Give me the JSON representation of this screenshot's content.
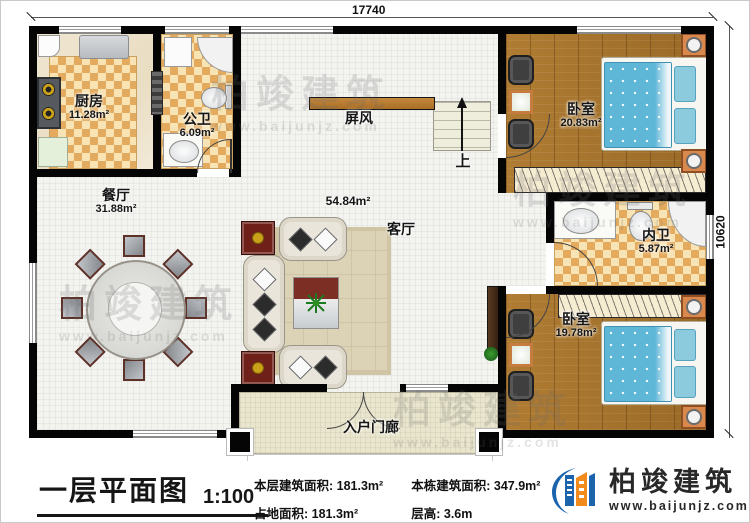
{
  "dimensions": {
    "top": "17740",
    "right": "10620"
  },
  "rooms": {
    "kitchen": {
      "name": "厨房",
      "area": "11.28m²"
    },
    "public_bath": {
      "name": "公卫",
      "area": "6.09m²"
    },
    "dining": {
      "name": "餐厅",
      "area": "31.88m²"
    },
    "living": {
      "name": "客厅",
      "area": "54.84m²"
    },
    "bedroom_top": {
      "name": "卧室",
      "area": "20.83m²"
    },
    "inner_bath": {
      "name": "内卫",
      "area": "5.87m²"
    },
    "bedroom_bottom": {
      "name": "卧室",
      "area": "19.78m²"
    },
    "porch": {
      "name": "入户门廊"
    }
  },
  "annotations": {
    "screen": "屏风",
    "stairs_up": "上"
  },
  "footer": {
    "title": "一层平面图",
    "scale": "1:100",
    "stats": [
      {
        "label": "本层建筑面积:",
        "value": "181.3m²"
      },
      {
        "label": "本栋建筑面积:",
        "value": "347.9m²"
      },
      {
        "label": "占地面积:",
        "value": "181.3m²"
      },
      {
        "label": "层高:",
        "value": "3.6m"
      }
    ],
    "logo": {
      "name": "柏竣建筑",
      "url": "www.baijunjz.com"
    }
  },
  "watermark": {
    "text": "柏竣建筑",
    "url": "www.baijunjz.com"
  },
  "colors": {
    "brand_blue": "#1b63ac",
    "brand_orange": "#f28a1e",
    "wall": "#050505",
    "wood_floor": "#a9752f",
    "tile_checker": "#e4ab5e",
    "bed_blue": "#5fb7d8"
  }
}
